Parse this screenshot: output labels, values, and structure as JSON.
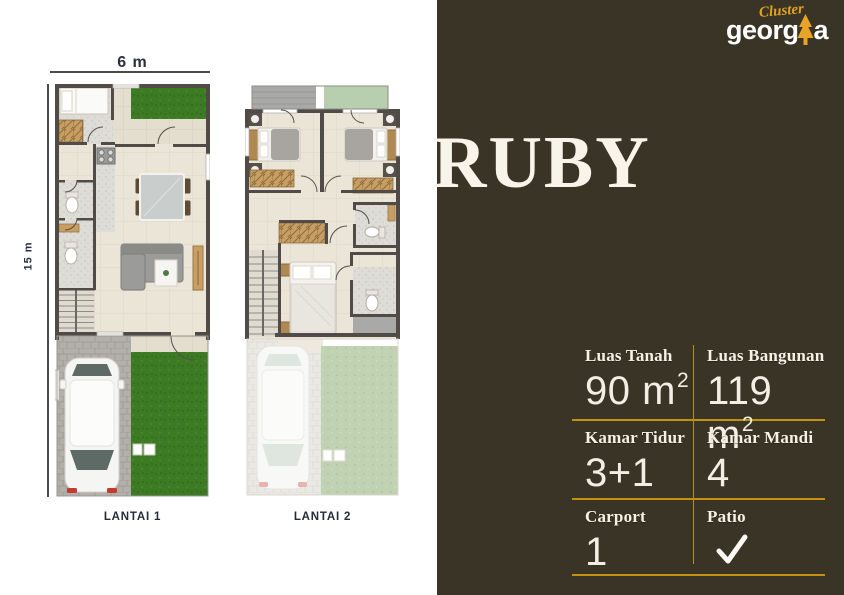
{
  "title": "RUBY",
  "brand": {
    "cluster": "Cluster",
    "name_pre": "georg",
    "name_post": "a"
  },
  "icons": {
    "brand_tree": "tree-icon",
    "patio": "check-icon"
  },
  "colors": {
    "panel_bg": "#3A3426",
    "accent_gold": "#C4910E",
    "logo_gold": "#E3A124",
    "cream_text": "#F6F1E4",
    "grass_green": "#3D7A24",
    "label_navy": "#252B39"
  },
  "specs": {
    "row1": {
      "left_label": "Luas Tanah",
      "left_value": "90 m",
      "left_sup": "2",
      "right_label": "Luas Bangunan",
      "right_value": "119 m",
      "right_sup": "2"
    },
    "row2": {
      "left_label": "Kamar Tidur",
      "left_value": "3+1",
      "right_label": "Kamar Mandi",
      "right_value": "4"
    },
    "row3": {
      "left_label": "Carport",
      "left_value": "1",
      "right_label": "Patio",
      "right_value": "check"
    }
  },
  "plans": {
    "plan1": {
      "label": "LANTAI 1",
      "width_dim": "6 m",
      "height_dim": "15 m"
    },
    "plan2": {
      "label": "LANTAI 2"
    }
  }
}
